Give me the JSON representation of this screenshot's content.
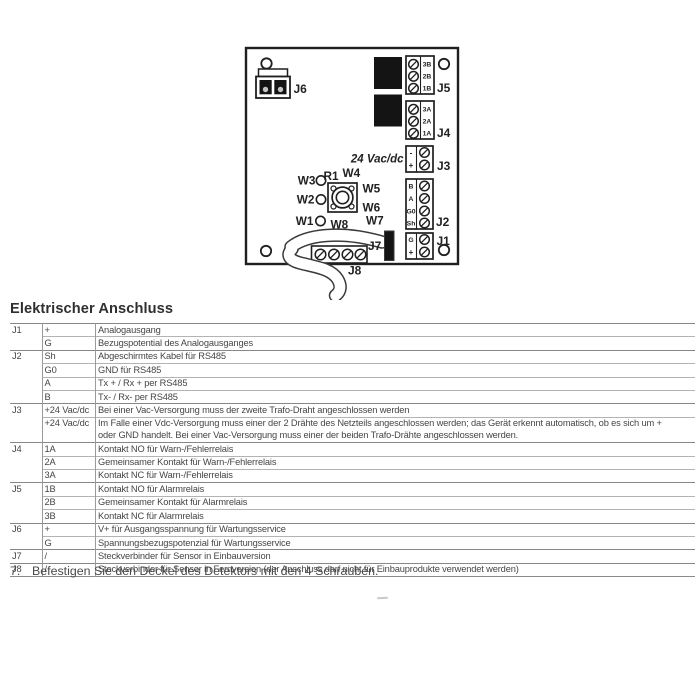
{
  "page": {
    "section_title": "Elektrischer Anschluss",
    "instruction_number": "7.",
    "instruction_text": "Befestigen Sie den Deckel des Detektors mit den 4 Schrauben."
  },
  "diagram": {
    "supply_label": "24 Vac/dc",
    "j6": {
      "label": "J6"
    },
    "j5": {
      "label": "J5",
      "pins": [
        "3B",
        "2B",
        "1B"
      ]
    },
    "j4": {
      "label": "J4",
      "pins": [
        "3A",
        "2A",
        "1A"
      ]
    },
    "j3": {
      "label": "J3",
      "pins": [
        "-",
        "+"
      ]
    },
    "j2": {
      "label": "J2",
      "pins": [
        "B",
        "A",
        "G0",
        "Sh"
      ]
    },
    "j1": {
      "label": "J1",
      "pins": [
        "G",
        "+"
      ]
    },
    "j7": {
      "label": "J7"
    },
    "j8": {
      "label": "J8"
    },
    "r1": {
      "label": "R1"
    },
    "w1": "W1",
    "w2": "W2",
    "w3": "W3",
    "w4": "W4",
    "w5": "W5",
    "w6": "W6",
    "w7": "W7",
    "w8": "W8"
  },
  "table": {
    "rows": [
      {
        "connector": "J1",
        "pin": "+",
        "desc": "Analogausgang",
        "group_start": true
      },
      {
        "connector": "",
        "pin": "G",
        "desc": "Bezugspotential des Analogausganges"
      },
      {
        "connector": "J2",
        "pin": "Sh",
        "desc": "Abgeschirmtes Kabel für RS485",
        "group_start": true
      },
      {
        "connector": "",
        "pin": "G0",
        "desc": "GND für RS485"
      },
      {
        "connector": "",
        "pin": "A",
        "desc": "Tx + / Rx + per RS485"
      },
      {
        "connector": "",
        "pin": "B",
        "desc": "Tx- / Rx- per RS485"
      },
      {
        "connector": "J3",
        "pin": "+24 Vac/dc",
        "desc": "Bei einer Vac-Versorgung muss der zweite Trafo-Draht angeschlossen werden",
        "group_start": true
      },
      {
        "connector": "",
        "pin": "+24 Vac/dc",
        "desc_lines": [
          "Im Falle einer Vdc-Versorgung muss einer der 2 Drähte des Netzteils angeschlossen werden; das Gerät erkennt automatisch, ob es sich um +",
          "oder GND handelt. Bei einer Vac-Versorgung muss einer der beiden Trafo-Drähte angeschlossen werden."
        ]
      },
      {
        "connector": "J4",
        "pin": "1A",
        "desc": "Kontakt NO für Warn-/Fehlerrelais",
        "group_start": true
      },
      {
        "connector": "",
        "pin": "2A",
        "desc": "Gemeinsamer Kontakt für Warn-/Fehlerrelais"
      },
      {
        "connector": "",
        "pin": "3A",
        "desc": "Kontakt NC für Warn-/Fehlerrelais"
      },
      {
        "connector": "J5",
        "pin": "1B",
        "desc": "Kontakt NO für Alarmrelais",
        "group_start": true
      },
      {
        "connector": "",
        "pin": "2B",
        "desc": "Gemeinsamer Kontakt für Alarmrelais"
      },
      {
        "connector": "",
        "pin": "3B",
        "desc": "Kontakt NC für Alarmrelais"
      },
      {
        "connector": "J6",
        "pin": "+",
        "desc": "V+ für Ausgangsspannung für Wartungsservice",
        "group_start": true
      },
      {
        "connector": "",
        "pin": "G",
        "desc": "Spannungsbezugspotenzial für Wartungsservice"
      },
      {
        "connector": "J7",
        "pin": "/",
        "desc": "Steckverbinder für Sensor in Einbauversion",
        "group_start": true
      },
      {
        "connector": "J8",
        "pin": "/",
        "desc": "Steckverbinder für Sensor in Fernversion (der Anschluss darf nicht für Einbauprodukte verwendet werden)",
        "group_start": true
      }
    ]
  }
}
